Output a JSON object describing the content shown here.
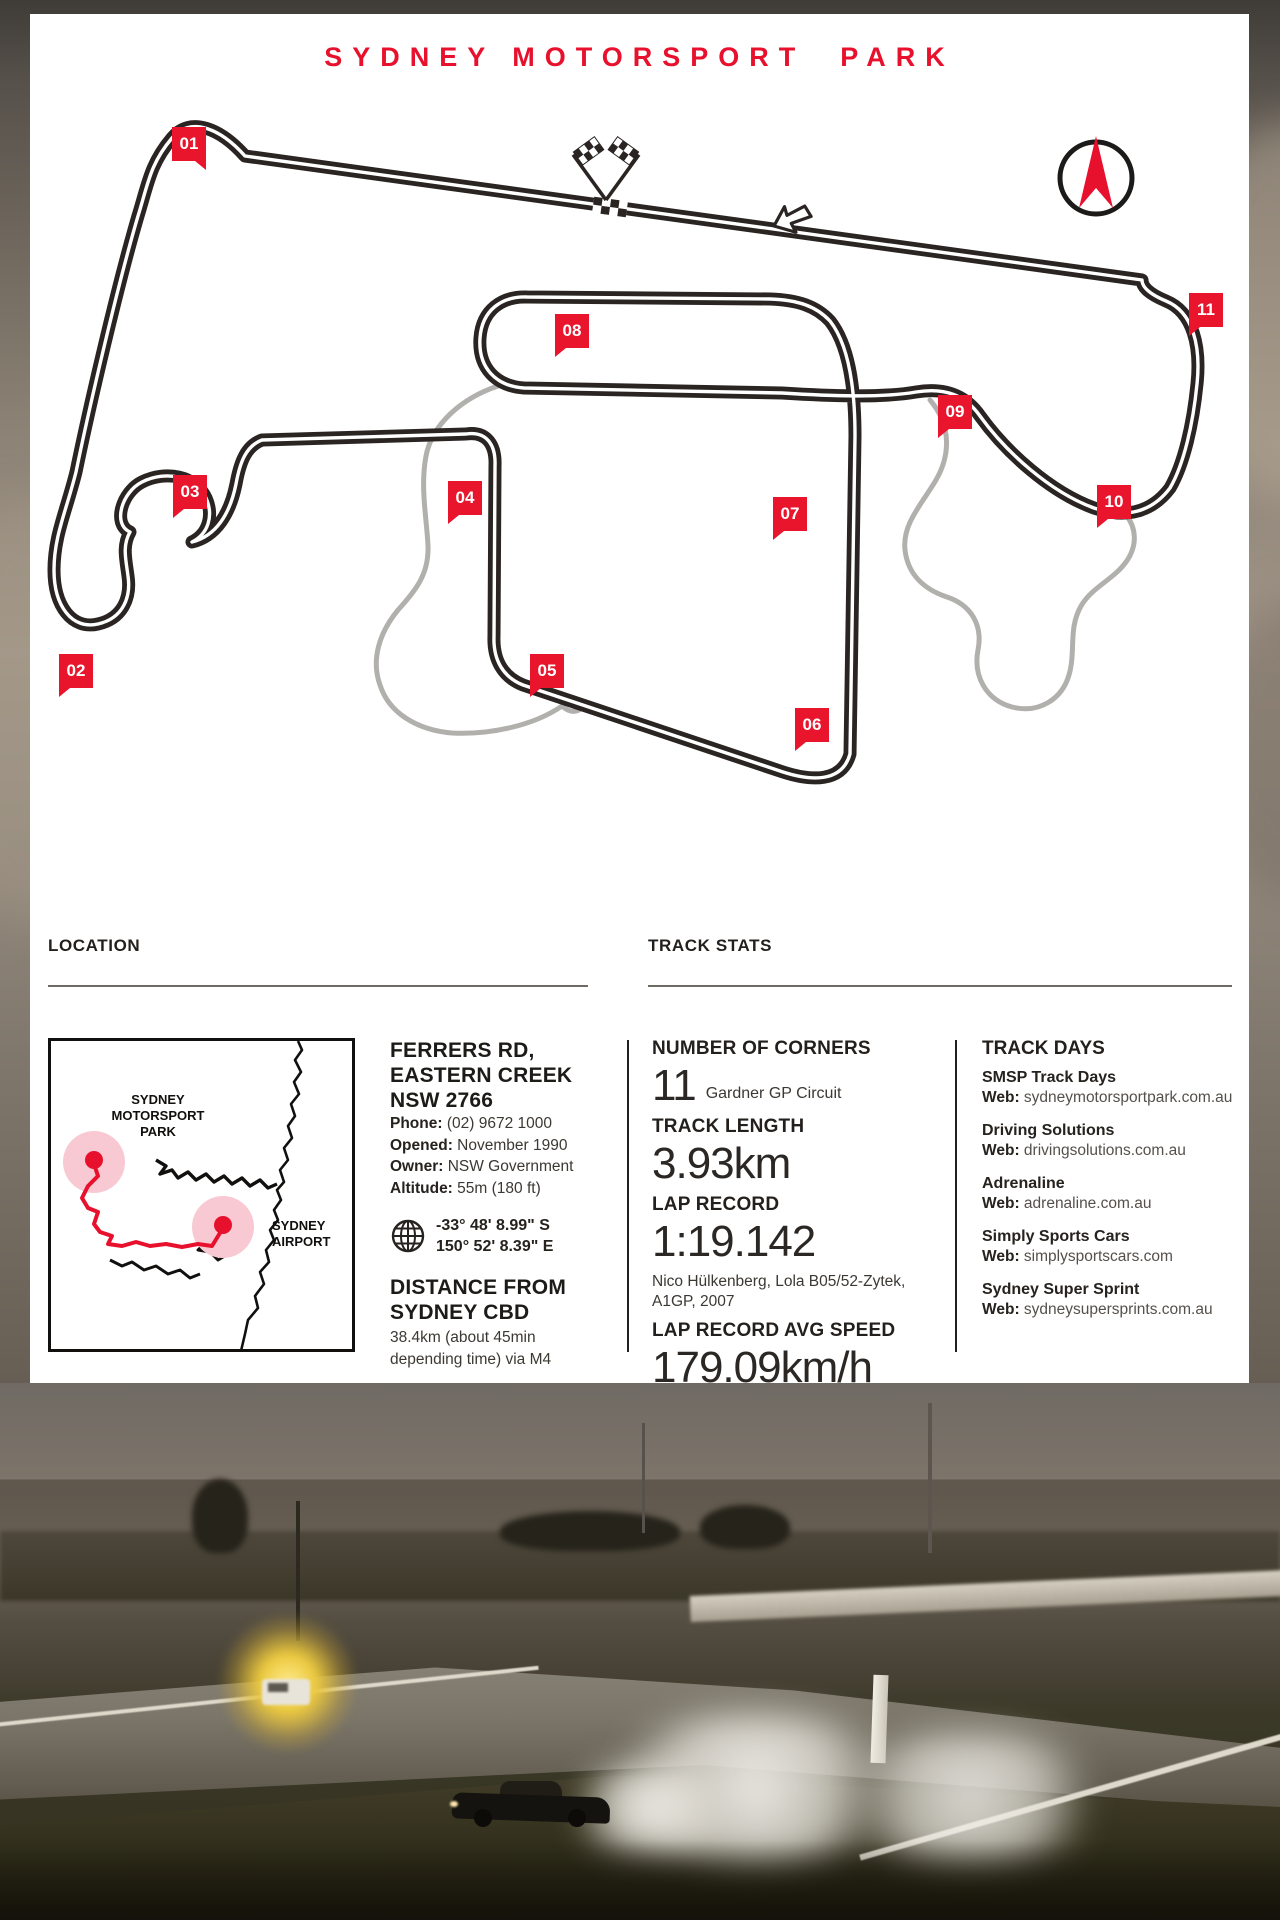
{
  "title": "SYDNEY MOTORSPORT  PARK",
  "colors": {
    "accent_red": "#e8112d",
    "track_black": "#2a2422",
    "alt_track_grey": "#b2b0ad",
    "heading_dark": "#231f1c"
  },
  "track_map": {
    "direction_note": "left-arrow-icon shows race direction",
    "corner_markers": [
      {
        "num": "01",
        "x": 159,
        "y": 130,
        "tail": "br"
      },
      {
        "num": "02",
        "x": 46,
        "y": 657,
        "tail": "bl"
      },
      {
        "num": "03",
        "x": 160,
        "y": 478,
        "tail": "bl"
      },
      {
        "num": "04",
        "x": 435,
        "y": 484,
        "tail": "bl"
      },
      {
        "num": "05",
        "x": 517,
        "y": 657,
        "tail": "bl"
      },
      {
        "num": "06",
        "x": 782,
        "y": 711,
        "tail": "bl"
      },
      {
        "num": "07",
        "x": 760,
        "y": 500,
        "tail": "bl"
      },
      {
        "num": "08",
        "x": 542,
        "y": 317,
        "tail": "bl"
      },
      {
        "num": "09",
        "x": 925,
        "y": 398,
        "tail": "bl"
      },
      {
        "num": "10",
        "x": 1084,
        "y": 488,
        "tail": "bl"
      },
      {
        "num": "11",
        "x": 1176,
        "y": 296,
        "tail": "bl"
      }
    ]
  },
  "location": {
    "heading": "LOCATION",
    "map": {
      "track_label_lines": [
        "SYDNEY",
        "MOTORSPORT",
        "PARK"
      ],
      "airport_label_lines": [
        "SYDNEY",
        "AIRPORT"
      ]
    },
    "address_line1": "FERRERS RD,",
    "address_line2": "EASTERN CREEK",
    "address_line3": "NSW 2766",
    "details": [
      {
        "label": "Phone:",
        "value": " (02) 9672 1000"
      },
      {
        "label": "Opened:",
        "value": " November 1990"
      },
      {
        "label": "Owner:",
        "value": " NSW Government"
      },
      {
        "label": "Altitude:",
        "value": " 55m (180 ft)"
      }
    ],
    "coords_line1": "-33° 48' 8.99\" S",
    "coords_line2": "150° 52' 8.39\" E",
    "distance_head_line1": "DISTANCE FROM",
    "distance_head_line2": "SYDNEY CBD",
    "distance_value_line1": "38.4km (about 45min",
    "distance_value_line2": "depending time) via M4"
  },
  "track_stats": {
    "heading": "TRACK STATS",
    "corners_label": "NUMBER OF CORNERS",
    "corners_value": "11",
    "corners_note": "Gardner GP Circuit",
    "length_label": "TRACK LENGTH",
    "length_value": "3.93km",
    "record_label": "LAP RECORD",
    "record_value": "1:19.142",
    "record_holder": "Nico Hülkenberg, Lola B05/52-Zytek, A1GP, 2007",
    "avg_label": "LAP RECORD AVG SPEED",
    "avg_value": "179.09km/h"
  },
  "track_days": {
    "heading": "TRACK DAYS",
    "providers": [
      {
        "name": "SMSP Track Days",
        "web_label": "Web:",
        "url": " sydneymotorsportpark.com.au"
      },
      {
        "name": "Driving Solutions",
        "web_label": "Web:",
        "url": " drivingsolutions.com.au"
      },
      {
        "name": "Adrenaline",
        "web_label": "Web:",
        "url": " adrenaline.com.au"
      },
      {
        "name": "Simply Sports Cars",
        "web_label": "Web:",
        "url": " simplysportscars.com"
      },
      {
        "name": "Sydney Super Sprint",
        "web_label": "Web:",
        "url": " sydneysupersprints.com.au"
      }
    ]
  }
}
